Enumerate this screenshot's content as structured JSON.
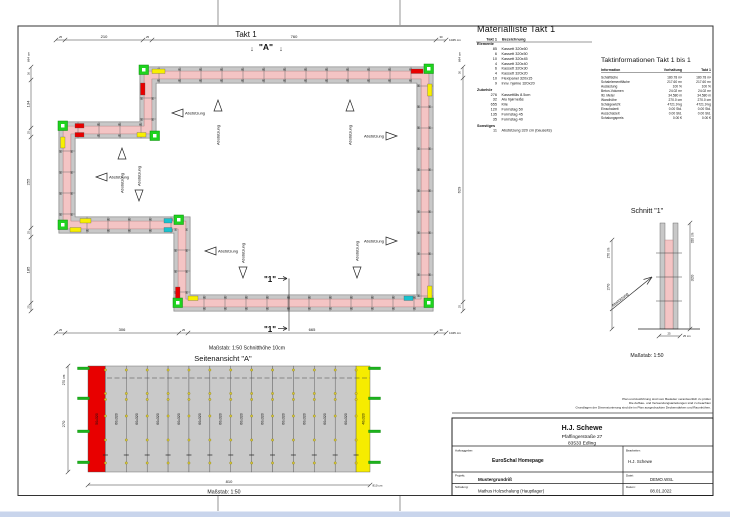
{
  "sheet": {
    "disclaimer": [
      "Plan und Ausführung sind vom Bauleiter verantwortlich zu prüfen",
      "Die Aufbau- und Verwendungsanleitungen sind zu beachten",
      "Grundlagen der Dimensionierung sind die im Plan ausgedruckten Deckenstärken und Raumhöhen."
    ]
  },
  "plan": {
    "title": "Takt 1",
    "view_marker": "\"A\"",
    "arrow_down": "↓",
    "section_label": "\"1\"",
    "support_label": "Abstützung",
    "panel_width_label": "60",
    "scale_note": "Maßstab: 1:50   Schnitthöhe 10cm",
    "dim_top": [
      "25",
      "210",
      "25",
      "760",
      "30",
      "1045 cm"
    ],
    "dim_bottom": [
      "25",
      "306",
      "25",
      "665",
      "30",
      "1045 cm"
    ],
    "dim_left": [
      "684 cm",
      "36",
      "134",
      "25",
      "255",
      "25",
      "185",
      "25"
    ],
    "dim_right": [
      "684 cm",
      "30",
      "629",
      "25"
    ]
  },
  "material_list": {
    "title": "Materialliste  Takt 1",
    "col_takt": "Takt 1",
    "col_bez": "Bezeichnung",
    "sections": [
      {
        "name": "Elemente",
        "rows": [
          [
            "85",
            "Kassett 320x60"
          ],
          [
            "6",
            "Kassett 320x50"
          ],
          [
            "10",
            "Kassett 320x45"
          ],
          [
            "4",
            "Kassett 320x40"
          ],
          [
            "6",
            "Kassett 320x30"
          ],
          [
            "4",
            "Kassett 320x20"
          ],
          [
            "10",
            "Flexipanel 320x15"
          ],
          [
            "9",
            "Innv. hjørne 320x20"
          ]
        ]
      },
      {
        "name": "Zubehör",
        "rows": [
          [
            "276",
            "Kassettlås 8.5cm"
          ],
          [
            "32",
            "Alu hjørnelås"
          ],
          [
            "655",
            "Kile"
          ],
          [
            "120",
            "Formstag 50"
          ],
          [
            "135",
            "Formstag 45"
          ],
          [
            "35",
            "Formstag 40"
          ]
        ]
      },
      {
        "name": "Sonstiges",
        "rows": [
          [
            "11",
            "Abstützung 320 cm (bauseits)"
          ]
        ]
      }
    ]
  },
  "takt_info": {
    "title": "Taktinformationen  Takt 1 bis 1",
    "columns": [
      "Information",
      "Vorhaltung",
      "Takt 1"
    ],
    "rows": [
      [
        "Schalfläche",
        "180.78 m²",
        "180.78 m²"
      ],
      [
        "Schalelementfläche",
        "217.60 m²",
        "217.60 m²"
      ],
      [
        "Auslastung",
        "100 %",
        "100 %"
      ],
      [
        "Beton-Volumen",
        "24.02 m³",
        "24.02 m³"
      ],
      [
        "lfd. Meter",
        "34.580 m",
        "34.580 m"
      ],
      [
        "Wandhöhe",
        "270.0 cm",
        "270.0 cm"
      ],
      [
        "Schalgewicht",
        "4721.9 kg",
        "4721.9 kg"
      ],
      [
        "Einschalzeit",
        "0.00 Std.",
        "0.00 Std."
      ],
      [
        "Ausschalzeit",
        "0.00 Std.",
        "0.00 Std."
      ],
      [
        "Schalungspreis",
        "0.00 €",
        "0.00 €"
      ]
    ]
  },
  "schnitt": {
    "title": "Schnitt \"1\"",
    "support_label": "Abstützung",
    "scale": "Maßstab: 1:50",
    "dim_left": [
      "270 cm",
      "270"
    ],
    "dim_right": [
      "320 cm",
      "320"
    ],
    "dim_bottom": [
      "25",
      "25 cm"
    ]
  },
  "side_view": {
    "title": "Seitenansicht \"A\"",
    "scale": "Maßstab: 1:50",
    "dim_left": [
      "270 cm",
      "270"
    ],
    "dim_bottom": [
      "810",
      "810 cm"
    ],
    "panels": [
      {
        "label": "50x320",
        "width_cm": 50,
        "color": "#e80000"
      },
      {
        "label": "60x320",
        "width_cm": 60,
        "color": "#c9c9c9"
      },
      {
        "label": "60x320",
        "width_cm": 60,
        "color": "#c9c9c9"
      },
      {
        "label": "60x320",
        "width_cm": 60,
        "color": "#c9c9c9"
      },
      {
        "label": "60x320",
        "width_cm": 60,
        "color": "#c9c9c9"
      },
      {
        "label": "60x320",
        "width_cm": 60,
        "color": "#c9c9c9"
      },
      {
        "label": "60x320",
        "width_cm": 60,
        "color": "#c9c9c9"
      },
      {
        "label": "60x320",
        "width_cm": 60,
        "color": "#c9c9c9"
      },
      {
        "label": "60x320",
        "width_cm": 60,
        "color": "#c9c9c9"
      },
      {
        "label": "60x320",
        "width_cm": 60,
        "color": "#c9c9c9"
      },
      {
        "label": "60x320",
        "width_cm": 60,
        "color": "#c9c9c9"
      },
      {
        "label": "60x320",
        "width_cm": 60,
        "color": "#c9c9c9"
      },
      {
        "label": "60x320",
        "width_cm": 60,
        "color": "#c9c9c9"
      },
      {
        "label": "40x320",
        "width_cm": 40,
        "color": "#f6ec00"
      }
    ]
  },
  "title_block": {
    "company": "H.J. Schewe",
    "address_line1": "Pfaffingerstraße 27",
    "address_line2": "83533 Edling",
    "auftraggeber_label": "Auftraggeber:",
    "auftraggeber": "EuroSchal Homepage",
    "bearbeiter_label": "Bearbeiter:",
    "bearbeiter": "H.J. Schewe",
    "projekt_label": "Projekt:",
    "projekt": "Mustergrundriß",
    "datei_label": "Datei:",
    "datei": "DEMO.WSL",
    "schalung_label": "Schalung:",
    "schalung": "Mathus Holzschalung (Hauptlager)",
    "datum_label": "Datum:",
    "datum": "08.01.2022"
  },
  "colors": {
    "wall_concrete": "#f4c4c4",
    "wall_edge": "#a07272",
    "panel_gray": "#c8c8c8",
    "corner_green": "#1ed31e",
    "accent_yellow": "#f8ef00",
    "accent_red": "#e80000",
    "accent_cyan": "#17c3cf",
    "tie_green": "#1db41d",
    "page_strip_blue": "#c9d5ec"
  }
}
